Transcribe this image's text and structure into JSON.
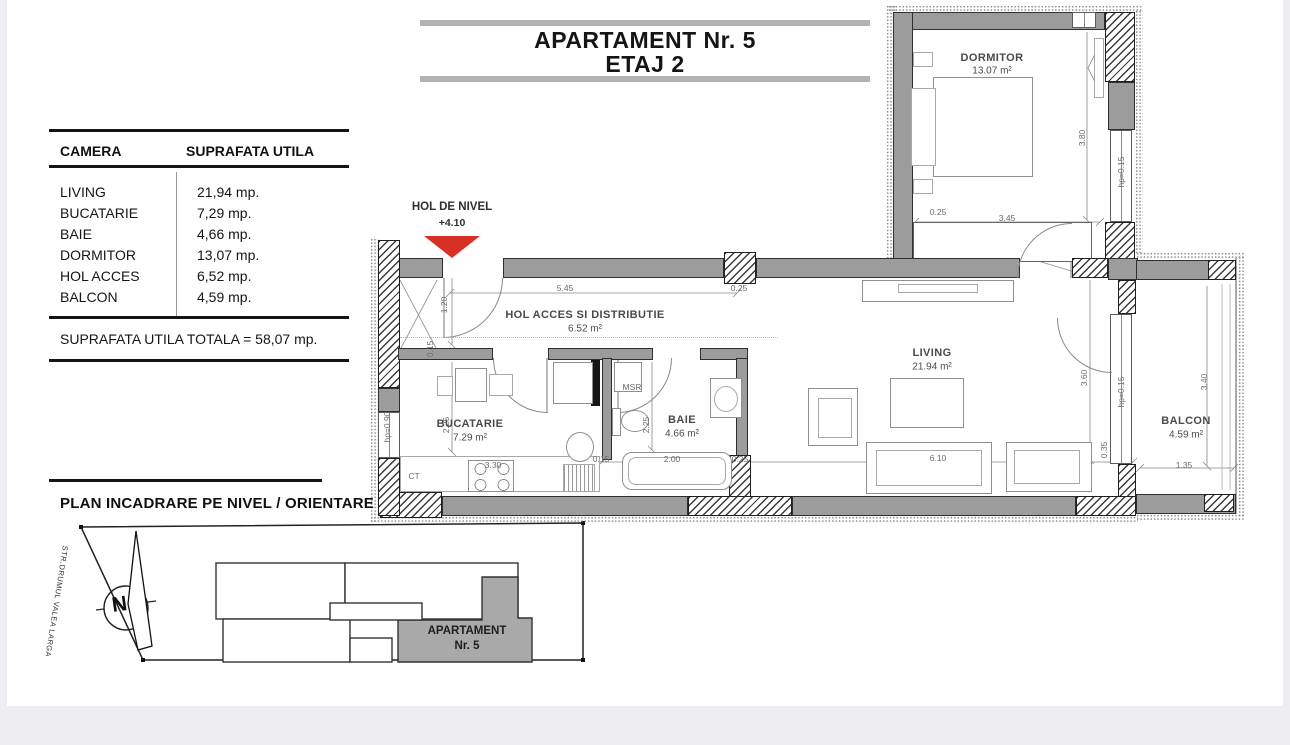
{
  "page": {
    "background": "#ededf2",
    "card": "#ffffff"
  },
  "title": {
    "line1": "APARTAMENT Nr. 5",
    "line2": "ETAJ 2"
  },
  "area_table": {
    "col_camera": "CAMERA",
    "col_suprafata": "SUPRAFATA UTILA",
    "rows": [
      {
        "camera": "LIVING",
        "suprafata": "21,94 mp."
      },
      {
        "camera": "BUCATARIE",
        "suprafata": "7,29 mp."
      },
      {
        "camera": "BAIE",
        "suprafata": "4,66 mp."
      },
      {
        "camera": "DORMITOR",
        "suprafata": "13,07 mp."
      },
      {
        "camera": "HOL ACCES",
        "suprafata": "6,52 mp."
      },
      {
        "camera": "BALCON",
        "suprafata": "4,59 mp."
      }
    ],
    "total": "SUPRAFATA UTILA TOTALA = 58,07 mp."
  },
  "level_marker": {
    "label": "HOL DE NIVEL",
    "value": "+4.10",
    "arrow_color": "#d93025"
  },
  "rooms": [
    {
      "name": "DORMITOR",
      "area": "13.07 m²"
    },
    {
      "name": "HOL ACCES SI DISTRIBUTIE",
      "area": "6.52 m²"
    },
    {
      "name": "LIVING",
      "area": "21.94 m²"
    },
    {
      "name": "BUCATARIE",
      "area": "7.29 m²"
    },
    {
      "name": "BAIE",
      "area": "4.66 m²"
    },
    {
      "name": "BALCON",
      "area": "4.59 m²"
    }
  ],
  "dimensions": [
    {
      "text": "0.25",
      "x": 938,
      "y": 212,
      "rot": 0
    },
    {
      "text": "3.45",
      "x": 1007,
      "y": 218,
      "rot": 0
    },
    {
      "text": "3.80",
      "x": 1082,
      "y": 138,
      "rot": -90
    },
    {
      "text": "hp=0.15",
      "x": 1121,
      "y": 172,
      "rot": -90
    },
    {
      "text": "0.25",
      "x": 739,
      "y": 288,
      "rot": 0
    },
    {
      "text": "5.45",
      "x": 565,
      "y": 288,
      "rot": 0
    },
    {
      "text": "1.20",
      "x": 444,
      "y": 305,
      "rot": -90
    },
    {
      "text": "0.15",
      "x": 430,
      "y": 349,
      "rot": -90
    },
    {
      "text": "2.25",
      "x": 446,
      "y": 425,
      "rot": -90
    },
    {
      "text": "3.30",
      "x": 493,
      "y": 465,
      "rot": 0
    },
    {
      "text": "CT",
      "x": 414,
      "y": 476,
      "rot": 0
    },
    {
      "text": "MSR",
      "x": 632,
      "y": 387,
      "rot": 0
    },
    {
      "text": "2.25",
      "x": 646,
      "y": 425,
      "rot": -90
    },
    {
      "text": "0.15",
      "x": 601,
      "y": 459,
      "rot": 0
    },
    {
      "text": "2.00",
      "x": 672,
      "y": 459,
      "rot": 0
    },
    {
      "text": "0.25",
      "x": 740,
      "y": 459,
      "rot": 0
    },
    {
      "text": "6.10",
      "x": 938,
      "y": 458,
      "rot": 0
    },
    {
      "text": "3.60",
      "x": 1084,
      "y": 378,
      "rot": -90
    },
    {
      "text": "hp=0.15",
      "x": 1121,
      "y": 392,
      "rot": -90
    },
    {
      "text": "0.35",
      "x": 1104,
      "y": 450,
      "rot": -90
    },
    {
      "text": "3.40",
      "x": 1204,
      "y": 382,
      "rot": -90
    },
    {
      "text": "1.35",
      "x": 1184,
      "y": 465,
      "rot": 0
    },
    {
      "text": "hp=0.90",
      "x": 387,
      "y": 427,
      "rot": -90
    }
  ],
  "site_plan": {
    "heading": "PLAN INCADRARE PE NIVEL / ORIENTARE",
    "street_label": "STR.DRUMUL VALEA LARGA",
    "compass_letter": "N",
    "apartment": {
      "line1": "APARTAMENT",
      "line2": "Nr. 5"
    }
  }
}
